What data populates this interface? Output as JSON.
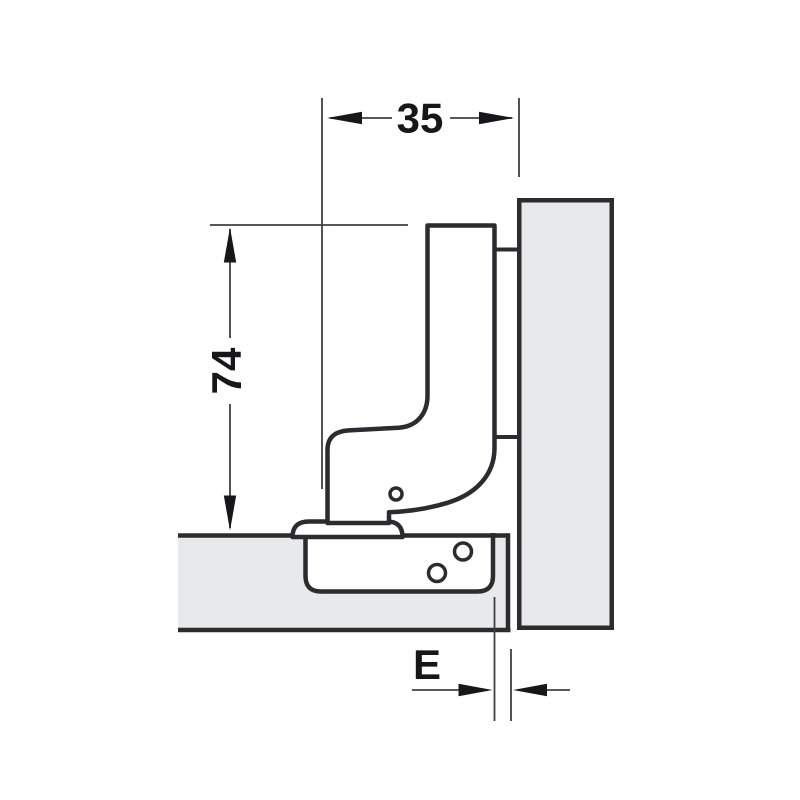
{
  "drawing": {
    "description": "hinge installation cross-section diagram",
    "labels": {
      "width": "35",
      "height": "74",
      "edge_distance": "E"
    },
    "colors": {
      "background": "#ffffff",
      "wood_fill": "#e8e9eb",
      "outline": "#2b2b30",
      "dimension_line": "#3f3f46",
      "label_text": "#17171a"
    }
  }
}
